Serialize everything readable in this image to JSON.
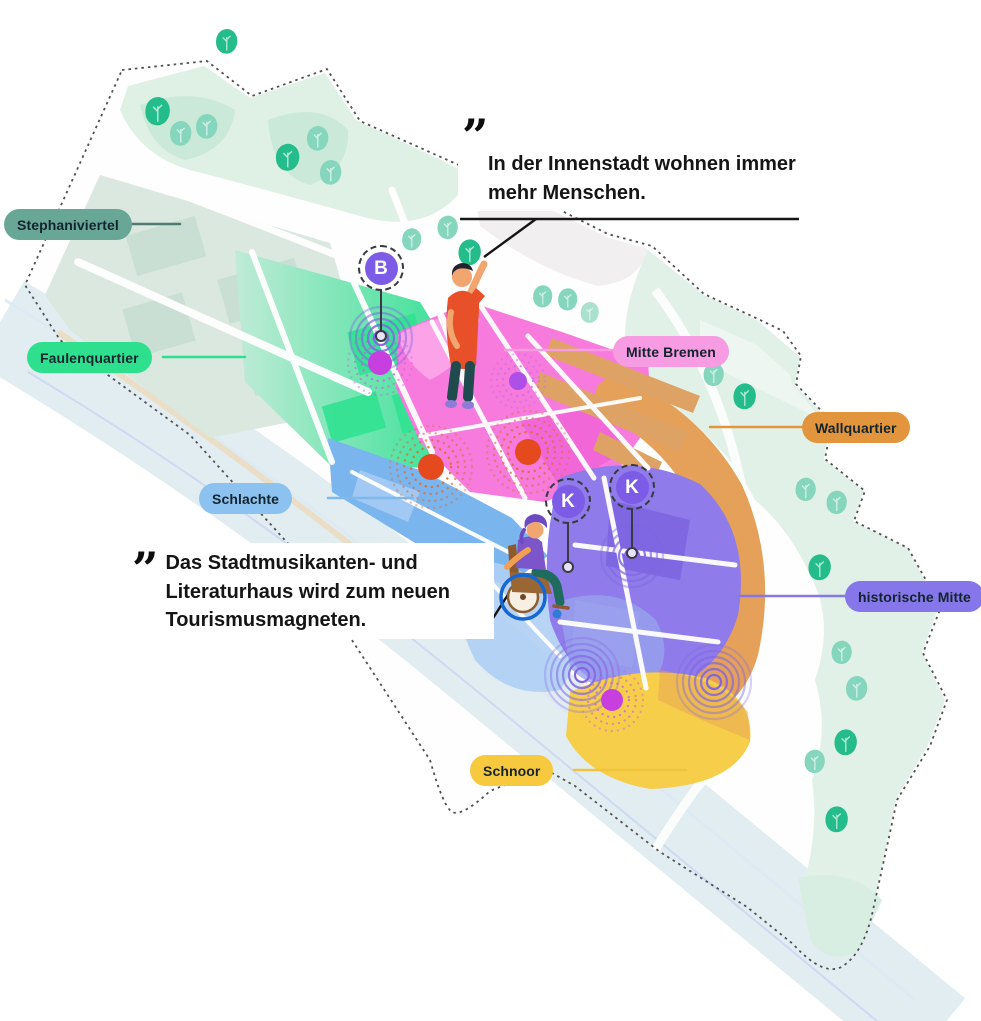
{
  "district_labels": [
    {
      "id": "stephaniviertel",
      "text": "Stephaniviertel",
      "color": "#68A795",
      "text_color": "#14242E"
    },
    {
      "id": "faulenquartier",
      "text": "Faulenquartier",
      "color": "#2EE08D",
      "text_color": "#14242E"
    },
    {
      "id": "schlachte",
      "text": "Schlachte",
      "color": "#8CC2EF",
      "text_color": "#14242E"
    },
    {
      "id": "mitte-bremen",
      "text": "Mitte Bremen",
      "color": "#F79BE3",
      "text_color": "#14242E"
    },
    {
      "id": "wallquartier",
      "text": "Wallquartier",
      "color": "#E2953C",
      "text_color": "#14242E"
    },
    {
      "id": "historische-mitte",
      "text": "historische Mitte",
      "color": "#8577E9",
      "text_color": "#14242E"
    },
    {
      "id": "schnoor",
      "text": "Schnoor",
      "color": "#F6C93F",
      "text_color": "#14242E"
    }
  ],
  "quotes": [
    {
      "mark": "”",
      "lines": [
        "In der Innenstadt wohnen immer",
        "mehr Menschen."
      ]
    },
    {
      "mark": "”",
      "lines": [
        "Das Stadtmusikanten- und",
        "Literaturhaus wird zum neuen",
        "Tourismusmagneten."
      ]
    }
  ],
  "badges": [
    {
      "letter": "B",
      "color": "#7C5BE6"
    },
    {
      "letter": "K",
      "color": "#7C5BE6"
    },
    {
      "letter": "K",
      "color": "#7C5BE6"
    }
  ],
  "icons": {
    "quote_icon": "”",
    "tree_icon": "stylized park tree",
    "waving_person_icon": "person waving",
    "wheelchair_person_icon": "person in wheelchair",
    "ripple_icon": "concentric activity rings",
    "dot_marker_icon": "point of interest dot"
  },
  "palette": {
    "badge_purple": "#7C5BE6",
    "ripple_purple": "#8066E3",
    "dot_red": "#E54A1F",
    "dot_magenta": "#C83FE0",
    "river": "#E2EDF2",
    "park_green": "#DFF0E5",
    "tree_green": "#24BC8A",
    "outline_gray": "#4F5054",
    "highlight_blue": "#1667D2"
  }
}
